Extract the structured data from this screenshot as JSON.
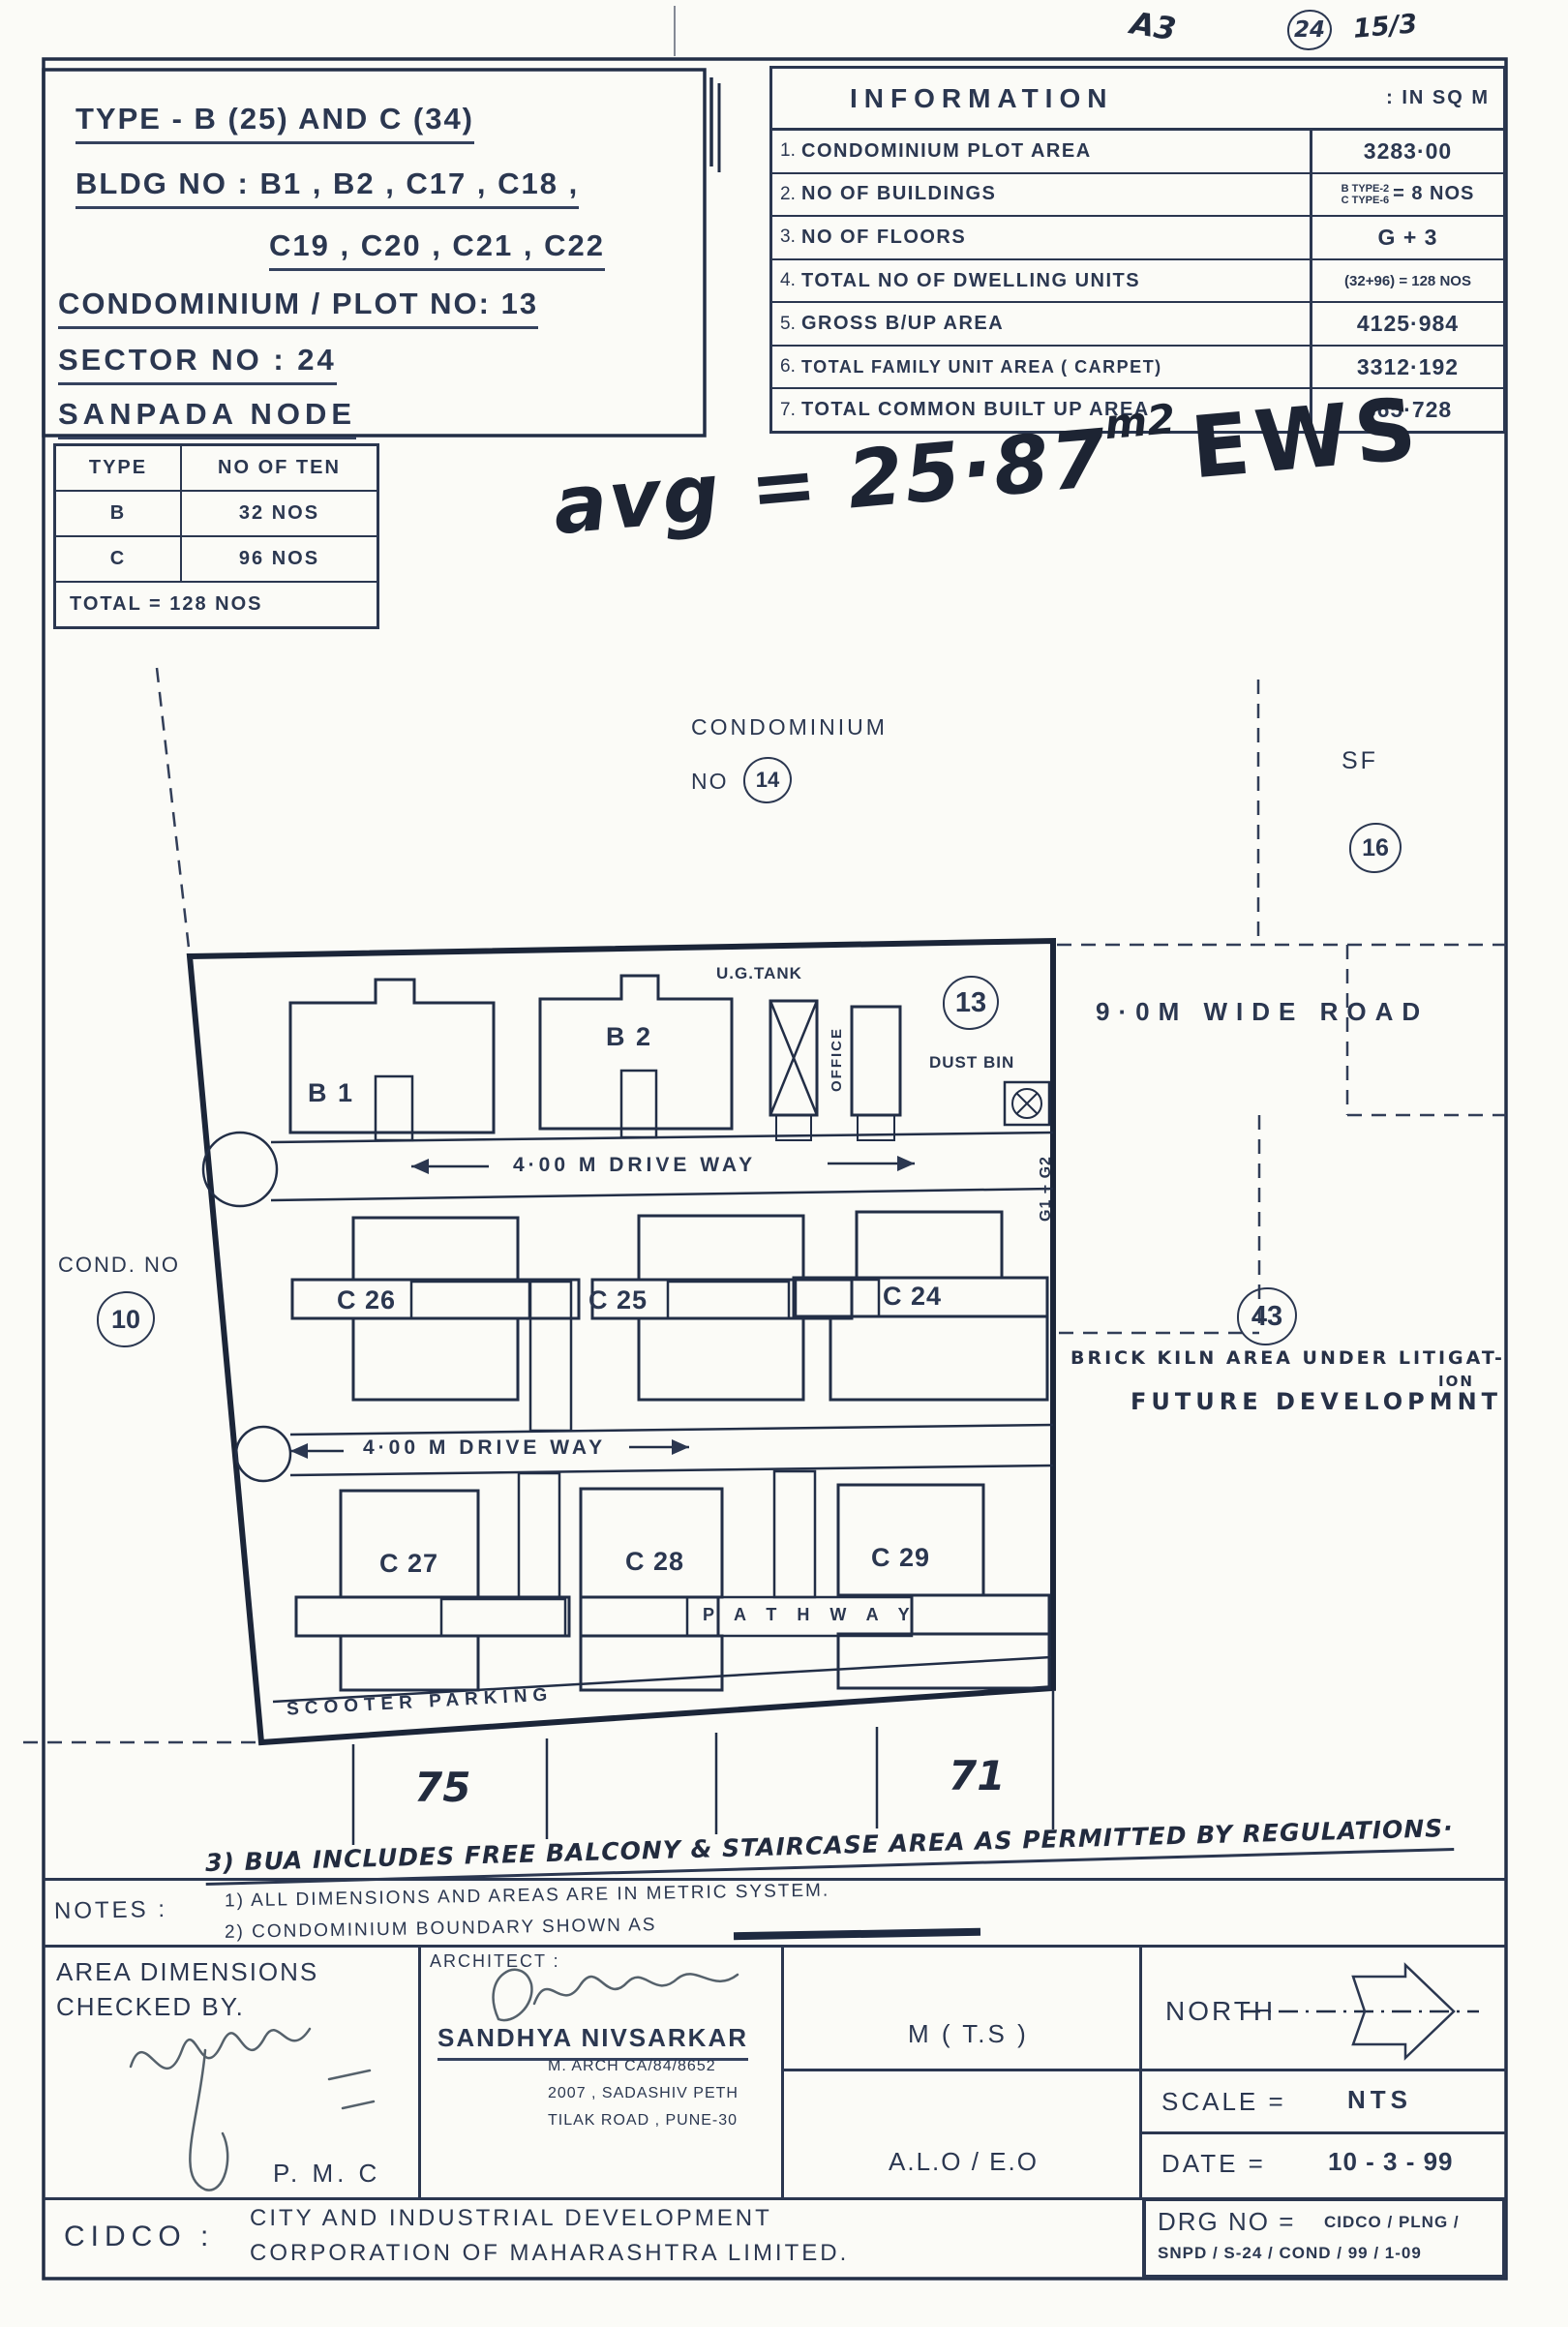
{
  "margin": {
    "mark": "A3",
    "circled": "24",
    "date_note": "15/3"
  },
  "title_box": {
    "line1": "TYPE - B (25) AND C (34)",
    "line2": "BLDG NO : B1 , B2 , C17 , C18 ,",
    "line3": "C19 , C20 , C21 , C22",
    "line4": "CONDOMINIUM / PLOT NO: 13",
    "line5": "SECTOR NO : 24",
    "line6": "SANPADA NODE"
  },
  "info_table": {
    "title": "INFORMATION",
    "unit": ": IN SQ M",
    "rows": [
      {
        "no": "1.",
        "label": "CONDOMINIUM PLOT AREA",
        "sub1": "",
        "sub2": "",
        "value": "3283·00"
      },
      {
        "no": "2.",
        "label": "NO OF BUILDINGS",
        "sub1": "B TYPE-2",
        "sub2": "C TYPE-6",
        "value": "= 8 NOS"
      },
      {
        "no": "3.",
        "label": "NO OF FLOORS",
        "sub1": "",
        "sub2": "",
        "value": "G + 3"
      },
      {
        "no": "4.",
        "label": "TOTAL NO OF DWELLING UNITS",
        "sub1": "",
        "sub2": "",
        "value": "(32+96) = 128 NOS"
      },
      {
        "no": "5.",
        "label": "GROSS B/UP AREA",
        "sub1": "",
        "sub2": "",
        "value": "4125·984"
      },
      {
        "no": "6.",
        "label": "TOTAL FAMILY UNIT AREA ( CARPET)",
        "sub1": "",
        "sub2": "",
        "value": "3312·192"
      },
      {
        "no": "7.",
        "label": "TOTAL COMMON BUILT UP AREA",
        "sub1": "",
        "sub2": "",
        "value": "365·728"
      }
    ]
  },
  "type_table": {
    "h1": "TYPE",
    "h2": "NO OF TEN",
    "r1c1": "B",
    "r1c2": "32 NOS",
    "r2c1": "C",
    "r2c2": "96 NOS",
    "total": "TOTAL = 128 NOS"
  },
  "avg_note": {
    "prefix": "avg = 25·87",
    "exp": "m2",
    "suffix": "EWS"
  },
  "plan": {
    "condominium": "CONDOMINIUM",
    "no_label": "NO",
    "no14": "14",
    "sf": "SF",
    "no16": "16",
    "no13": "13",
    "no10": "10",
    "no43": "43",
    "cond_no": "COND. NO",
    "road": "9·0M WIDE ROAD",
    "driveway1": "4·00 M  DRIVE  WAY",
    "driveway2": "4·00 M  DRIVE  WAY",
    "ug_tank": "U.G.TANK",
    "office": "OFFICE",
    "dust_bin": "DUST BIN",
    "g1g2": "G1 + G2",
    "b1": "B 1",
    "b2": "B 2",
    "c24": "C 24",
    "c25": "C 25",
    "c26": "C 26",
    "c27": "C 27",
    "c28": "C 28",
    "c29": "C 29",
    "pathway": "P A T H  W A Y",
    "scooter": "SCOOTER  PARKING",
    "brick1": "BRICK KILN AREA UNDER LITIGAT-",
    "brick2": "ION",
    "future": "FUTURE DEVELOPMNT",
    "d75": "75",
    "d71": "71"
  },
  "notes": {
    "hand": "3) BUA INCLUDES FREE BALCONY & STAIRCASE AREA AS PERMITTED BY REGULATIONS·",
    "label": "NOTES :",
    "n1": "1) ALL DIMENSIONS AND AREAS ARE IN METRIC SYSTEM.",
    "n2": "2) CONDOMINIUM BOUNDARY SHOWN AS"
  },
  "footer": {
    "checked1": "AREA DIMENSIONS",
    "checked2": "CHECKED BY.",
    "pmc": "P. M. C",
    "arch_label": "ARCHITECT :",
    "arch_name": "SANDHYA NIVSARKAR",
    "arch_reg": "M. ARCH  CA/84/8652",
    "arch_addr1": "2007 , SADASHIV PETH",
    "arch_addr2": "TILAK ROAD , PUNE-30",
    "mts": "M ( T.S )",
    "aloeo": "A.L.O / E.O",
    "north": "NORTH",
    "scale_l": "SCALE =",
    "scale_v": "NTS",
    "date_l": "DATE  =",
    "date_v": "10 - 3 - 99",
    "drg_l": "DRG NO =",
    "drg1": "CIDCO / PLNG /",
    "drg2": "SNPD / S-24 / COND / 99 / 1-09",
    "cidco": "CIDCO :",
    "corp1": "CITY  AND  INDUSTRIAL  DEVELOPMENT",
    "corp2": "CORPORATION  OF  MAHARASHTRA  LIMITED."
  }
}
